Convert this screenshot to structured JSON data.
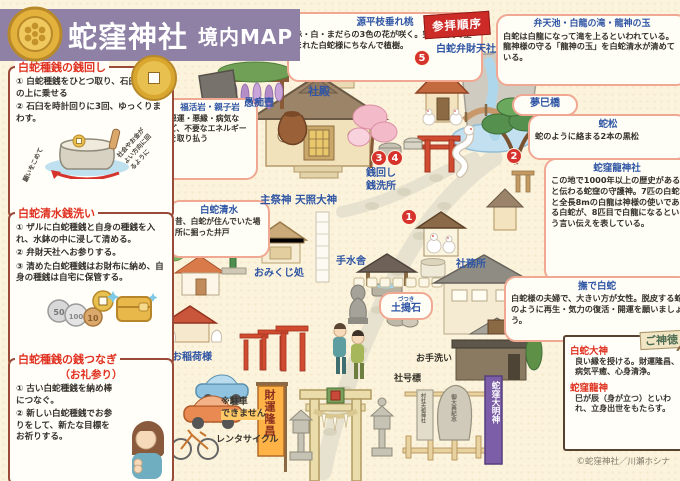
{
  "header": {
    "title": "蛇窪神社",
    "subtitle": "境内MAP"
  },
  "order_flag": "参拝順序",
  "info_boxes": [
    {
      "title": "白蛇種銭の銭回し",
      "steps": [
        "① 白蛇種銭をひとつ取り、石臼の金杯の上に乗せる",
        "② 石臼を時計回りに3回、ゆっくりまわす。"
      ],
      "notes": [
        "願いをこめて",
        "社会やお金がよい方向に回るように"
      ]
    },
    {
      "title": "白蛇清水銭洗い",
      "steps": [
        "① ザルに白蛇種銭と自身の種銭を入れ、水鉢の中に浸して清める。",
        "② 弁財天社へお参りする。",
        "③ 清めた白蛇種銭はお財布に納め、自身の種銭は自宅に保管する。"
      ],
      "coin_labels": [
        "50",
        "100",
        "10"
      ]
    },
    {
      "title": "白蛇種銭の銭つなぎ",
      "subtitle": "（お礼参り）",
      "steps": [
        "① 古い白蛇種銭を納め棒につなぐ。",
        "② 新しい白蛇種銭でお参りをして、新たな目標をお祈りする。"
      ]
    }
  ],
  "annotations": {
    "genpei": {
      "title": "源平枝垂れ桃",
      "text": "赤・白・まだらの3色の花が咲く。突然変異で生まれた白蛇様にちなんで植樹。"
    },
    "benten": {
      "title": "弁天池・白龍の滝・龍神の玉",
      "text": "白蛇は白龍になって滝を上るといわれている。龍神様の守る「龍神の玉」を白蛇清水が清めている。"
    },
    "yumemibashi": {
      "title": "夢巳橋"
    },
    "hebimatsu": {
      "title": "蛇松",
      "text": "蛇のように絡まる2本の黒松"
    },
    "ryujinja": {
      "title": "蛇窪龍神社",
      "text": "この地で1000年以上の歴史があると伝わる蛇窪の守護神。7匹の白蛇と全長8mの白龍は神様の使いである白蛇が、8匹目で白龍になるという言い伝えを表している。"
    },
    "nadeshirohebi": {
      "title": "撫で白蛇",
      "text": "白蛇様の夫婦で、大きい方が女性。脱皮する蛇のように再生・気力の復活・開運を願いましょう。"
    },
    "fukkatsuiwa": {
      "title": "福活岩・親子岩",
      "text": "悪運・悪縁・病気など、不要なエネルギーを取り払う"
    },
    "shirohebishimizu": {
      "title": "白蛇清水",
      "text": "昔、白蛇が住んでいた場所に掘った井戸"
    }
  },
  "map_labels": {
    "hakuja_bentensha": "白蛇弁財天社",
    "shaden": "社殿",
    "guchitsubo": "愚痴壺",
    "shusaijin": "主祭神 天照大神",
    "omikuji": "おみくじ処",
    "zenimawashi": "銭回し\n銭洗所",
    "chozuya": "手水舎",
    "dotsukiishi": "土搗石",
    "dotsukiishi_furigana": "づつき",
    "shamusho": "社務所",
    "oinarisama": "お稲荷様",
    "otearai": "お手洗い",
    "shagohyo": "社号標",
    "rentacycle": "レンタサイクル",
    "no_parking": "※駐車\nできません",
    "hebikubo_daimyojin": "蛇窪大明神",
    "zaiun_ryusho": "財運隆昌",
    "sonsha_tenso": "村社天祖神社",
    "gotaiten_kinen": "御大典紀念"
  },
  "numbers": {
    "n1": "1",
    "n2": "2",
    "n3": "3",
    "n4": "4",
    "n5": "5"
  },
  "shintoku": {
    "title": "ご神徳",
    "entries": [
      {
        "name": "白蛇大神",
        "text": "良い縁を授ける。財運隆昌、病気平癒、心身清浄。"
      },
      {
        "name": "蛇窪龍神",
        "text": "巳が辰（身が立つ）といわれ、立身出世をもたらす。"
      }
    ]
  },
  "copyright": "©蛇窪神社／川瀬ホシナ",
  "colors": {
    "banner_purple": "#8F81A5",
    "accent_red": "#E0301F",
    "label_blue": "#2F55A4",
    "badge_red": "#D5332B",
    "gold": "#E8C050"
  }
}
